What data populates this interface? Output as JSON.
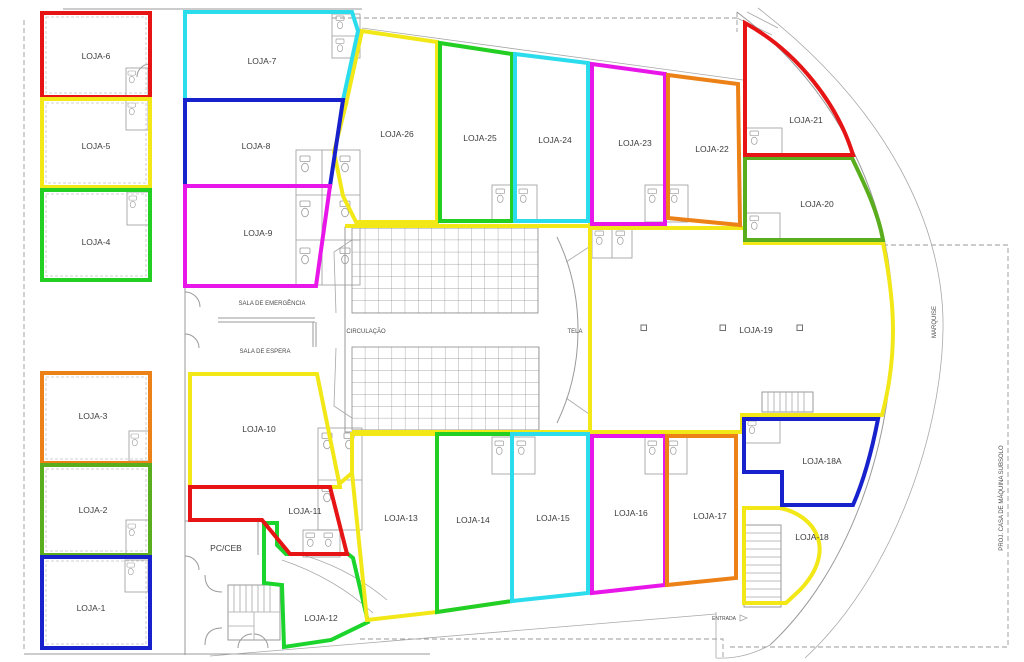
{
  "plan_title": "Pavimento - plano de lojas (floor plan)",
  "units": {
    "loja1": {
      "label": "LOJA-1",
      "color": "#1822cc"
    },
    "loja2": {
      "label": "LOJA-2",
      "color": "#5aad1c"
    },
    "loja3": {
      "label": "LOJA-3",
      "color": "#ec8118"
    },
    "loja4": {
      "label": "LOJA-4",
      "color": "#24cf24"
    },
    "loja5": {
      "label": "LOJA-5",
      "color": "#f2e818"
    },
    "loja6": {
      "label": "LOJA-6",
      "color": "#e61414"
    },
    "loja7": {
      "label": "LOJA-7",
      "color": "#2bdcec"
    },
    "loja8": {
      "label": "LOJA-8",
      "color": "#1822cc"
    },
    "loja9": {
      "label": "LOJA-9",
      "color": "#e816e8"
    },
    "loja10": {
      "label": "LOJA-10",
      "color": "#f2e818"
    },
    "loja11": {
      "label": "LOJA-11",
      "color": "#e61414"
    },
    "loja12": {
      "label": "LOJA-12",
      "color": "#1bd42c"
    },
    "loja13": {
      "label": "LOJA-13",
      "color": "#f2e818"
    },
    "loja14": {
      "label": "LOJA-14",
      "color": "#24cf24"
    },
    "loja15": {
      "label": "LOJA-15",
      "color": "#2bdcec"
    },
    "loja16": {
      "label": "LOJA-16",
      "color": "#e816e8"
    },
    "loja17": {
      "label": "LOJA-17",
      "color": "#ec8118"
    },
    "loja18": {
      "label": "LOJA-18",
      "color": "#f2e818"
    },
    "loja18a": {
      "label": "LOJA-18A",
      "color": "#1822cc"
    },
    "loja19": {
      "label": "LOJA-19",
      "color": "#f2e818"
    },
    "loja20": {
      "label": "LOJA-20",
      "color": "#5aad1c"
    },
    "loja21": {
      "label": "LOJA-21",
      "color": "#e61414"
    },
    "loja22": {
      "label": "LOJA-22",
      "color": "#ec8118"
    },
    "loja23": {
      "label": "LOJA-23",
      "color": "#e816e8"
    },
    "loja24": {
      "label": "LOJA-24",
      "color": "#2bdcec"
    },
    "loja25": {
      "label": "LOJA-25",
      "color": "#24cf24"
    },
    "loja26": {
      "label": "LOJA-26",
      "color": "#f2e818"
    }
  },
  "rooms": {
    "sala_emergencia": "SALA DE EMERGÊNCIA",
    "sala_espera": "SALA DE ESPERA",
    "circulacao": "CIRCULAÇÃO",
    "tela": "TELA",
    "pc_ceb": "PC/CEB",
    "entrada": "ENTRADA",
    "marquise": "MARQUISE",
    "proj_casa": "PROJ. CASA DE MÁQUINA SUBSOLO"
  }
}
